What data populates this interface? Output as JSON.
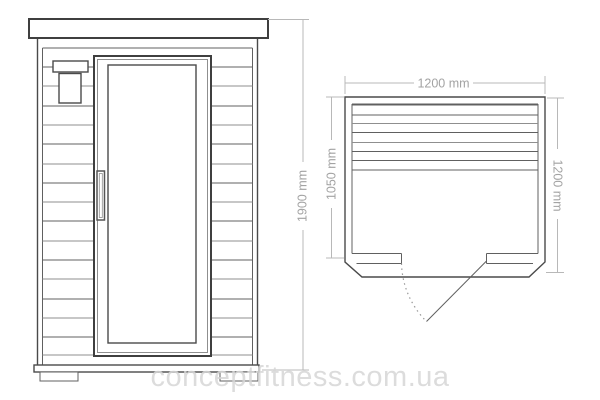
{
  "diagram": {
    "type": "sauna-cabin-technical-drawing",
    "views": {
      "front_view": {
        "name": "front-elevation",
        "dimensions": {
          "height": "1900 mm"
        }
      },
      "top_view": {
        "name": "top-plan",
        "dimensions": {
          "width": "1200 mm",
          "inner_depth": "1050 mm",
          "depth": "1200 mm"
        }
      }
    },
    "watermark": "conceptfitness.com.ua",
    "colors": {
      "background": "#ffffff",
      "outline_dark": "#3f3f3f",
      "outline_medium": "#4a4a4a",
      "outline_light": "#8f8f8f",
      "dimension_line": "#b8b8b8",
      "dimension_text": "#a3a3a3",
      "watermark_text": "#d7d7d7"
    }
  }
}
